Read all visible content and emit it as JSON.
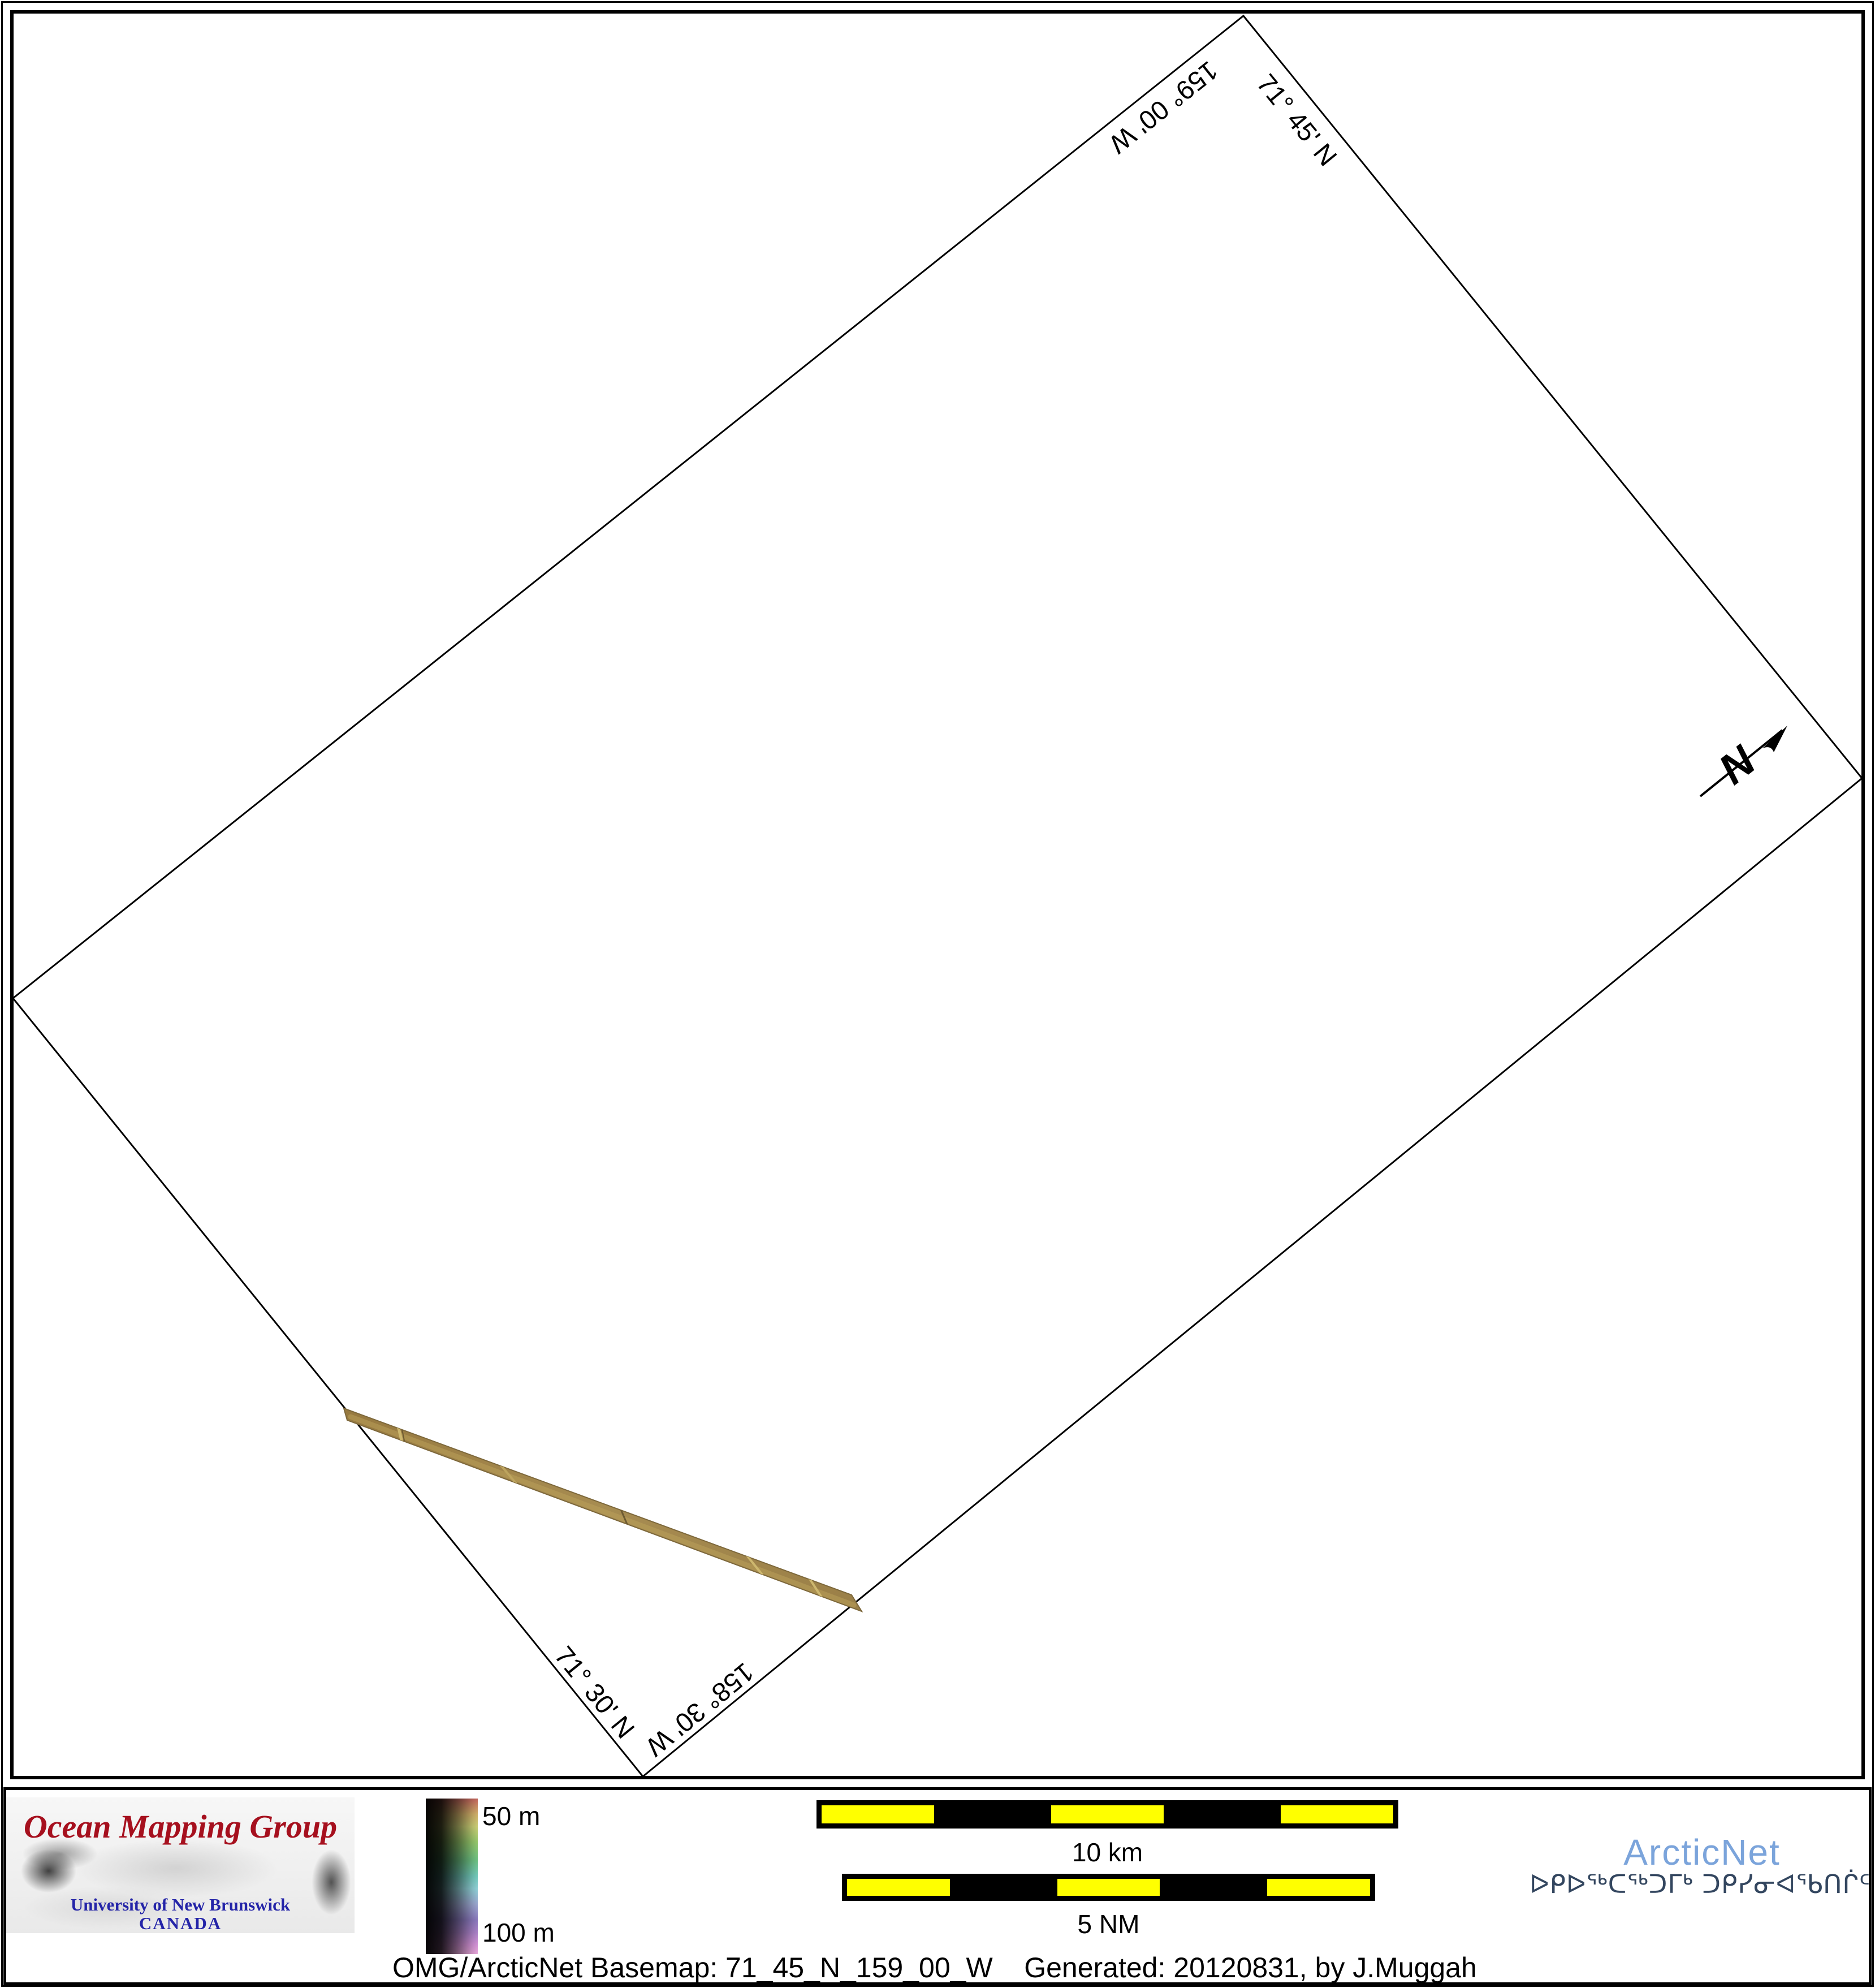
{
  "map": {
    "labels": [
      {
        "id": "longitude-top",
        "text": "159° 00' W"
      },
      {
        "id": "latitude-top",
        "text": "71° 45' N"
      },
      {
        "id": "latitude-bottom",
        "text": "71° 30' N"
      },
      {
        "id": "longitude-bottom",
        "text": "158° 30' W"
      }
    ],
    "north_arrow": {
      "label": "N"
    }
  },
  "legend": {
    "omg_logo": {
      "title": "Ocean Mapping Group",
      "university": "University of New Brunswick",
      "country": "CANADA"
    },
    "colorbar": {
      "top_label": "50 m",
      "bottom_label": "100 m"
    },
    "scalebars": [
      {
        "label": "10 km"
      },
      {
        "label": "5 NM"
      }
    ],
    "arcticnet": {
      "wordmark": "ArcticNet",
      "inuktitut": "ᐅᑭᐅᖅᑕᖅᑐᒥᒃ ᑐᑭᓯᓂᐊᖃᑎᒌᑦ"
    },
    "caption": "OMG/ArcticNet Basemap: 71_45_N_159_00_W    Generated: 20120831, by J.Muggah"
  },
  "colors": {
    "omg-red": "#A6101E",
    "omg-blue": "#2424A8",
    "arcticnet-blue": "#7BA4DB",
    "syllabics-navy": "#33465F",
    "scalebar-yellow": "#FFFF00",
    "swath-tan": "#A08648"
  }
}
